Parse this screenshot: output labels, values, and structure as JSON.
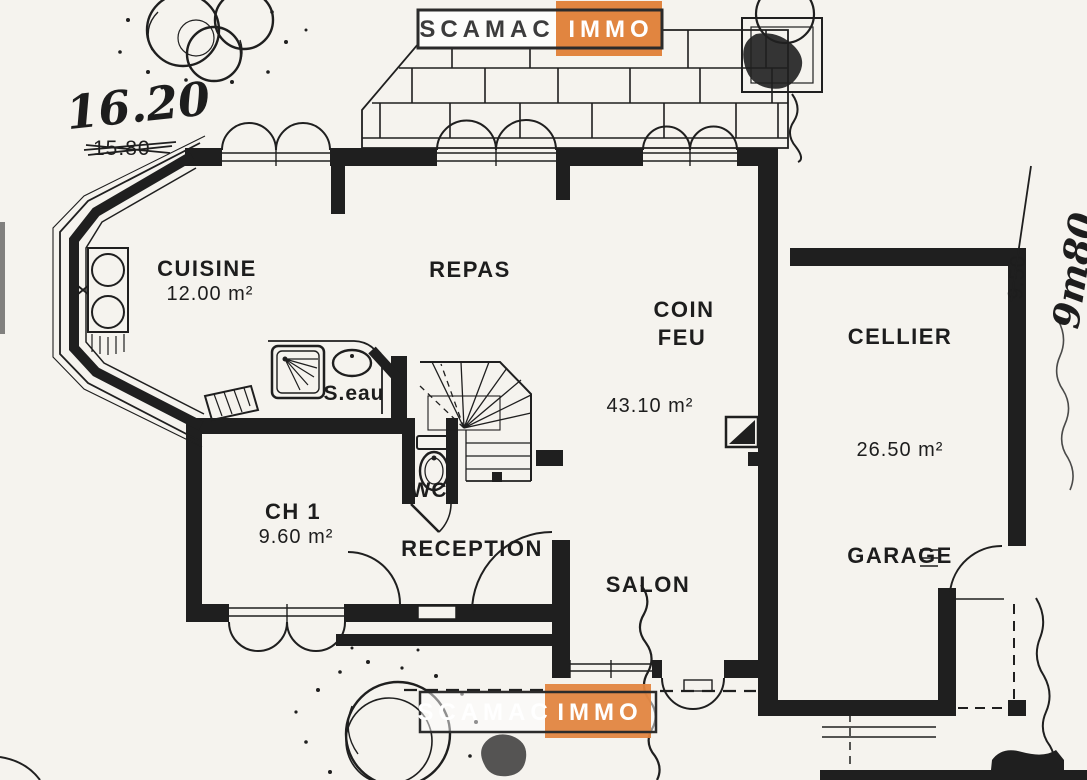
{
  "palette": {
    "paper": "#f5f3ee",
    "ink": "#1f1f1f",
    "accent_orange": "#e18540",
    "logo_text_dark": "#3c3c3c",
    "logo_text_light": "#ffffff"
  },
  "branding": {
    "logo_top": {
      "left": "SCAMAC",
      "right": "IMMO"
    },
    "logo_bottom": {
      "left": "SCAMAC",
      "right": "IMMO"
    }
  },
  "annotations": {
    "width_handwritten": "16.20",
    "width_printed_struck": "15.80",
    "depth_printed_struck": "9.50",
    "depth_handwritten": "9m80"
  },
  "rooms": {
    "cuisine": {
      "label": "CUISINE",
      "area": "12.00 m²"
    },
    "repas": {
      "label": "REPAS"
    },
    "coin_feu": {
      "line1": "COIN",
      "line2": "FEU",
      "area": "43.10 m²"
    },
    "cellier": {
      "label": "CELLIER",
      "area": "26.50 m²"
    },
    "garage": {
      "label": "GARAGE"
    },
    "salon": {
      "label": "SALON"
    },
    "reception": {
      "label": "RECEPTION"
    },
    "ch1": {
      "label": "CH 1",
      "area": "9.60 m²"
    },
    "salle_eau": {
      "label": "S.eau"
    },
    "wc": {
      "label": "WC"
    }
  }
}
